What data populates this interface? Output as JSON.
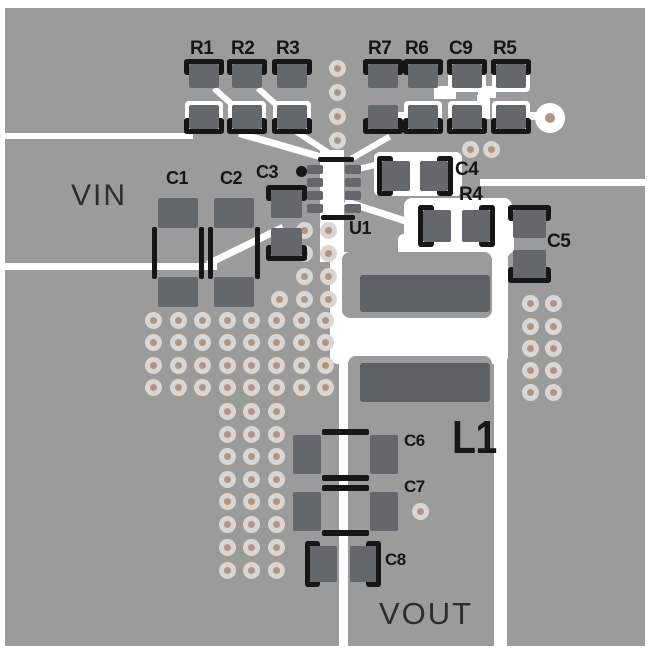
{
  "colors": {
    "margin": "#ffffff",
    "board": "#9b9b9b",
    "pad": "#64676b",
    "pad_large": "#5e6165",
    "silkscreen": "#161616",
    "trace": "#ffffff",
    "via_ring": "#d9d7d4",
    "via_center": "#b29483",
    "net_label": "#2d2d2d"
  },
  "silkscreen_labels": {
    "r1": "R1",
    "r2": "R2",
    "r3": "R3",
    "r7": "R7",
    "r6": "R6",
    "c9": "C9",
    "r5": "R5",
    "c1": "C1",
    "c2": "C2",
    "c3": "C3",
    "c4": "C4",
    "r4": "R4",
    "c5": "C5",
    "u1": "U1",
    "l1": "L1",
    "c6": "C6",
    "c7": "C7",
    "c8": "C8"
  },
  "net_labels": {
    "vin": "VIN",
    "vout": "VOUT"
  }
}
